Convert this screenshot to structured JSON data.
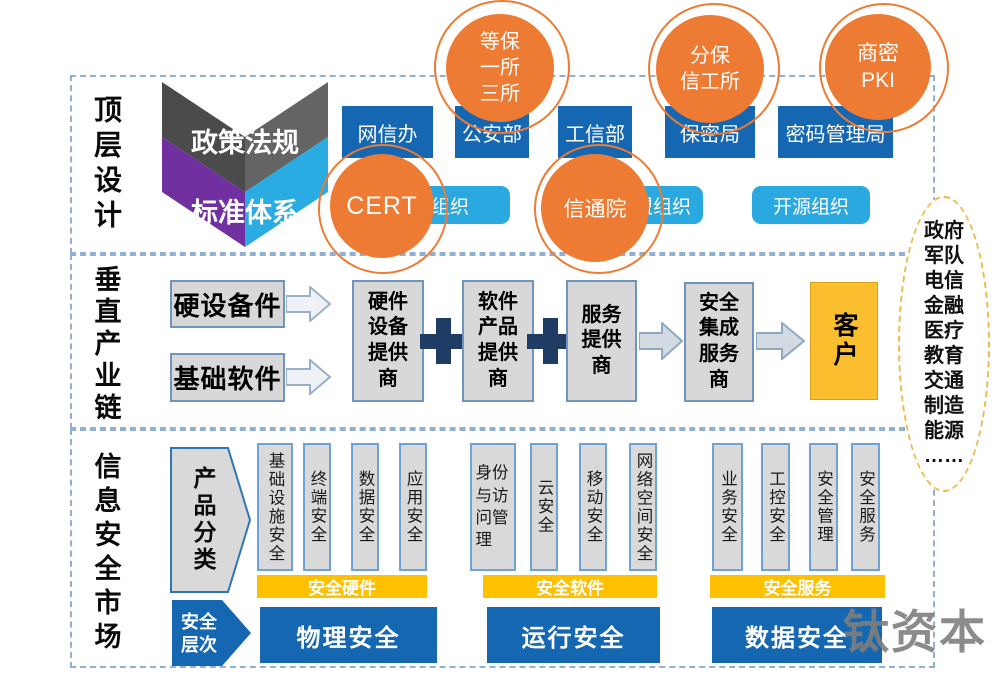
{
  "colors": {
    "dark_blue": "#1667b1",
    "light_blue": "#29a9e0",
    "orange": "#ed7b33",
    "yellow": "#ffc000",
    "purple": "#7030a0",
    "cyan": "#2aabe2",
    "dark_gray": "#4e4e4e",
    "box_gray": "#d9d9d9",
    "dashed_border": "#8fb0d4",
    "ellipse_dash": "#f0b94d"
  },
  "top": {
    "label": "顶层设计",
    "chevron": {
      "policy": "政策法规",
      "standard": "标准体系"
    },
    "gov": [
      "网信办",
      "公安部",
      "工信部",
      "保密局",
      "密码管理局"
    ],
    "orgs": [
      "行业组织",
      "联盟组织",
      "开源组织"
    ],
    "circles": [
      {
        "name": "dengbao",
        "text": "等保\n一所\n三所"
      },
      {
        "name": "fenbao",
        "text": "分保\n信工所"
      },
      {
        "name": "shangmi-pki",
        "text": "商密\nPKI"
      },
      {
        "name": "cert",
        "text": "CERT"
      },
      {
        "name": "xintongyuan",
        "text": "信通院"
      }
    ]
  },
  "middle": {
    "label": "垂直产业链",
    "inputs": [
      "硬设备件",
      "基础软件"
    ],
    "chain": [
      "硬件\n设备\n提供\n商",
      "软件\n产品\n提供\n商",
      "服务\n提供\n商"
    ],
    "integrator": "安全\n集成\n服务\n商",
    "customer": "客户",
    "customer_types": "政府\n军队\n电信\n金融\n医疗\n教育\n交通\n制造\n能源\n……"
  },
  "bottom": {
    "label": "信息安全市场",
    "product_axis": "产品分类",
    "layer_axis": "安全\n层次",
    "groups": [
      {
        "columns": [
          "基础设施安全",
          "终端安全",
          "数据安全",
          "应用安全"
        ],
        "category": "安全硬件",
        "layer": "物理安全"
      },
      {
        "columns": [
          "身份与访问管理",
          "云安全",
          "移动安全",
          "网络空间安全"
        ],
        "category": "安全软件",
        "layer": "运行安全"
      },
      {
        "columns": [
          "业务安全",
          "工控安全",
          "安全管理",
          "安全服务"
        ],
        "category": "安全服务",
        "layer": "数据安全"
      }
    ]
  },
  "watermark": "钛资本"
}
